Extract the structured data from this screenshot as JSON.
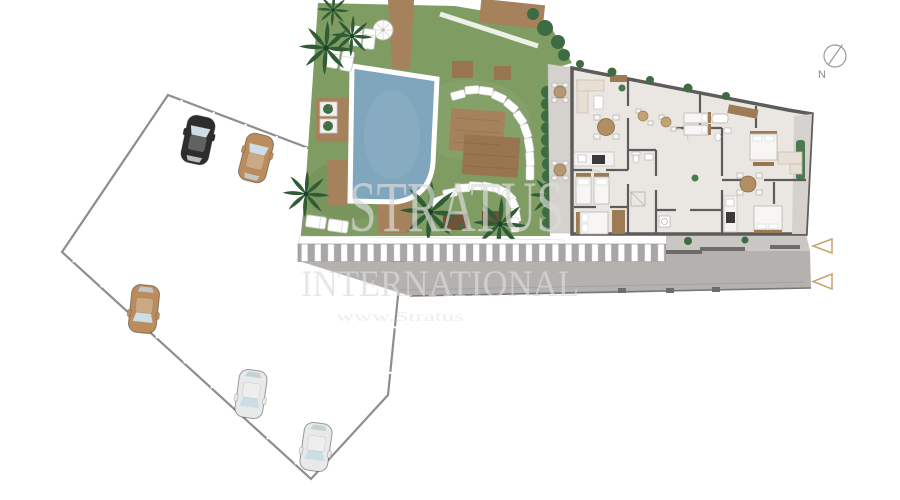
{
  "watermark": {
    "brand": "STRATUS",
    "subtitle": "INTERNATIONAL",
    "website_text": "www.Stratus"
  },
  "compass": {
    "north_label": "N"
  },
  "colors": {
    "background": "#ffffff",
    "parking": "#b9b7b8",
    "parking_edge": "#8f8d8e",
    "stall_line": "#ffffff",
    "road": "#b4b1af",
    "courtyard": "#c9c6c3",
    "lawn": "#7f9c63",
    "pool_water": "#7fa6bc",
    "pool_coping": "#ffffff",
    "wood_deck": "#a5825c",
    "wood_dark": "#98754f",
    "palm": "#2f5c35",
    "hedge": "#3d6b42",
    "wall": "#5e5c5a",
    "floor": "#eae7e2",
    "terrace": "#d5d2ce",
    "furniture_beige": "#e7dfd3",
    "furniture_brown": "#9c7b55",
    "watermark": "#dcdcdc",
    "arrow_gold": "#c7a36e",
    "compass_gray": "#9b9b9b"
  },
  "parking": {
    "cars": [
      {
        "label": "black car",
        "hex": "#2e2d2d"
      },
      {
        "label": "tan car",
        "hex": "#bb8c5c"
      },
      {
        "label": "tan car",
        "hex": "#bb8c5c"
      },
      {
        "label": "white car",
        "hex": "#e9e9e9"
      },
      {
        "label": "white car",
        "hex": "#e9e9e9"
      }
    ]
  }
}
